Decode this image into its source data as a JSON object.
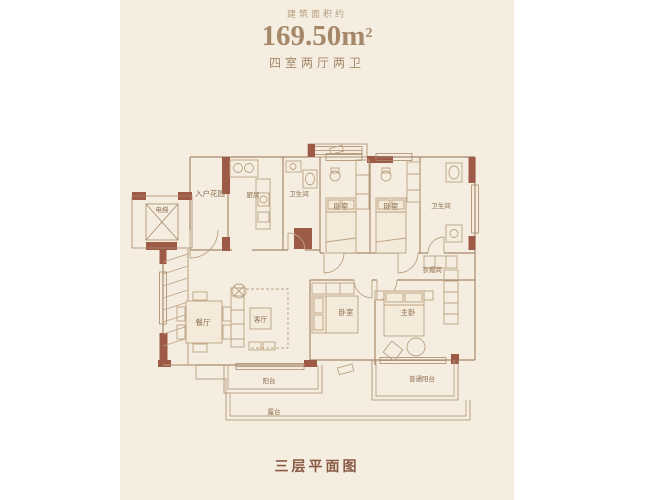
{
  "header": {
    "subtitle": "建筑面积约",
    "area_value": "169.50",
    "area_unit": "m",
    "area_sup": "2",
    "layout_text": "四室两厅两卫"
  },
  "footer": {
    "title": "三层平面图"
  },
  "floorplan": {
    "labels": {
      "elevator": "电梯",
      "entry_garden": "入户花园",
      "kitchen": "厨房",
      "bath_top_left": "卫生间",
      "bedroom_top_1": "卧室",
      "bedroom_top_2": "卧室",
      "bath_top_right": "卫生间",
      "cloakroom": "衣帽间",
      "dining": "餐厅",
      "living": "客厅",
      "bedroom_bottom": "卧室",
      "master_bedroom": "主卧",
      "balcony": "阳台",
      "terrace": "露台",
      "secondary_balcony": "普通阳台"
    },
    "colors": {
      "panel_background": "#f5eee0",
      "wall_accent": "#9d5a46",
      "wall_line": "#a8896b",
      "furniture_line": "#bca183",
      "label_text": "#8c6d50",
      "header_text": "#a5886a",
      "footer_text": "#8a5a45"
    }
  }
}
